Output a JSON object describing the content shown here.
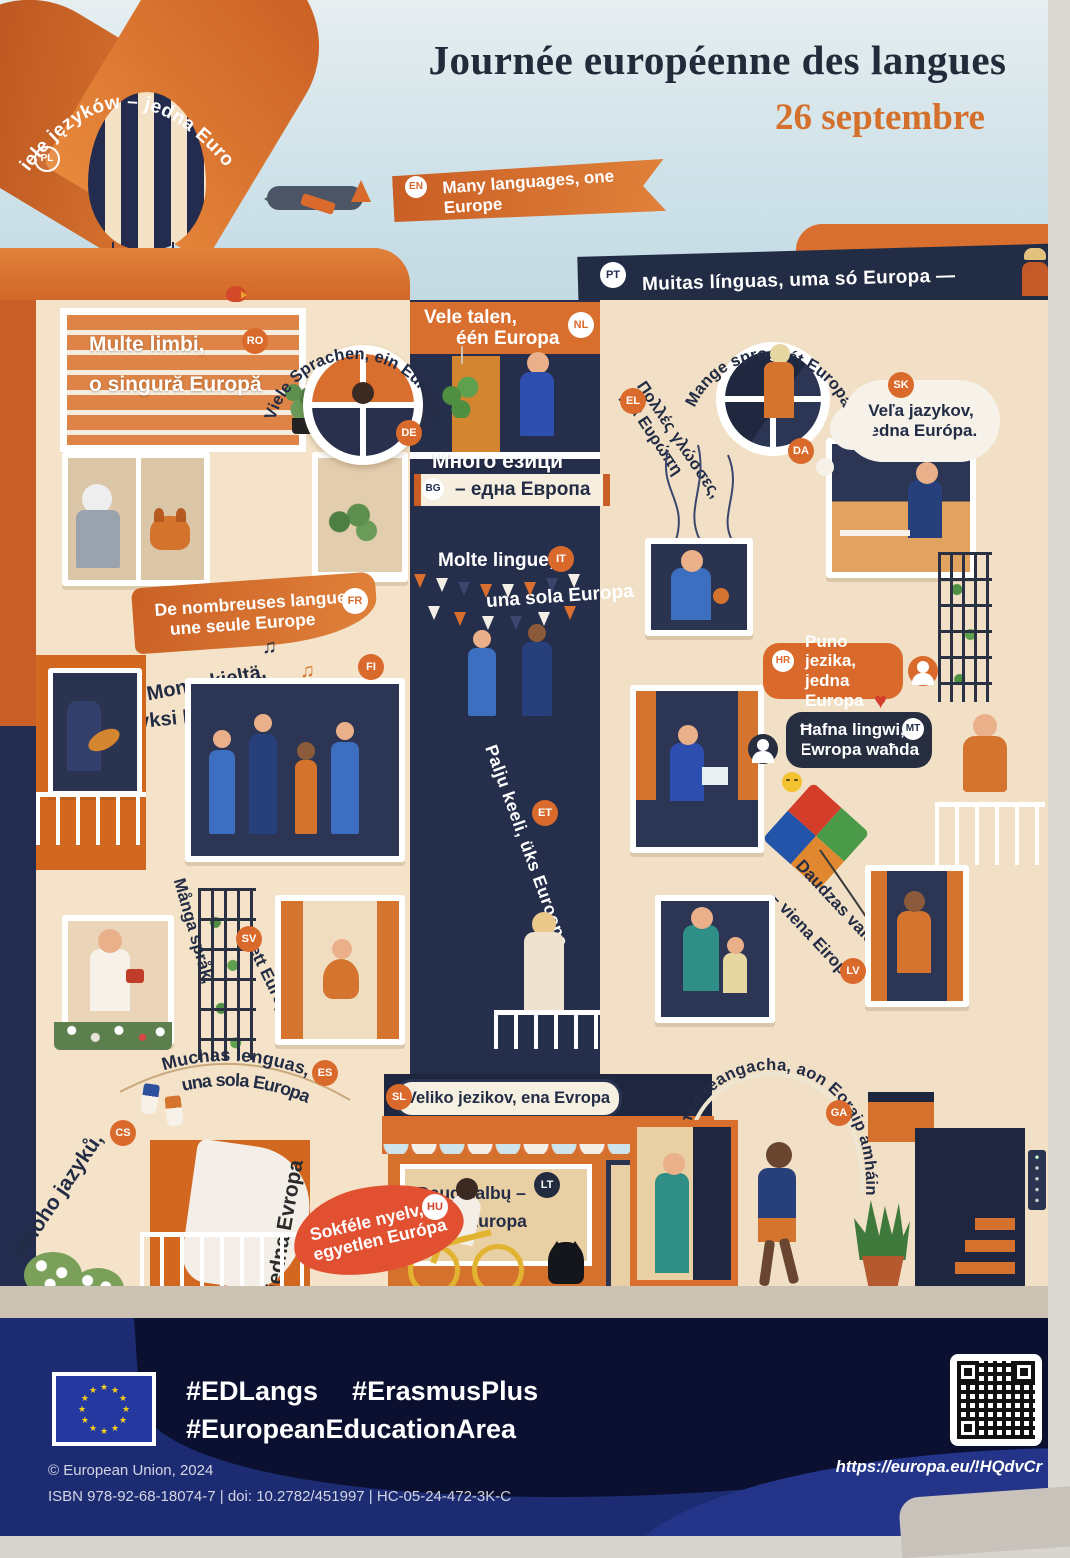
{
  "header": {
    "title": "Journée européenne des langues",
    "date": "26 septembre"
  },
  "languages": {
    "pl": {
      "code": "PL",
      "text": "Wiele języków – jedna Europa"
    },
    "en": {
      "code": "EN",
      "text": "Many languages, one Europe"
    },
    "pt": {
      "code": "PT",
      "text": "Muitas línguas, uma só Europa —"
    },
    "ro": {
      "code": "RO",
      "l1": "Multe limbi,",
      "l2": "o singură Europă"
    },
    "de": {
      "code": "DE",
      "text": "Viele Sprachen, ein Europa,"
    },
    "nl": {
      "code": "NL",
      "l1": "Vele talen,",
      "l2": "één Europa"
    },
    "bg": {
      "code": "BG",
      "l1": "Много езици",
      "l2": "– една Европа"
    },
    "el": {
      "code": "EL",
      "l1": "Πολλές γλώσσες,",
      "l2": "μία Ευρώπη"
    },
    "da": {
      "code": "DA",
      "text": "Mange sprog, ét Europa"
    },
    "sk": {
      "code": "SK",
      "l1": "Veľa jazykov,",
      "l2": "jedna Európa."
    },
    "it": {
      "code": "IT",
      "l1": "Molte lingue,",
      "l2": "una sola Europa"
    },
    "fr": {
      "code": "FR",
      "l1": "De nombreuses langues",
      "l2": "une seule Europe"
    },
    "fi": {
      "code": "FI",
      "l1": "Monta kieltä,",
      "l2": "yksi Eurooppa"
    },
    "hr": {
      "code": "HR",
      "l1": "Puno jezika,",
      "l2": "jedna Europa"
    },
    "mt": {
      "code": "MT",
      "l1": "Ħafna lingwi,",
      "l2": "Ewropa waħda"
    },
    "et": {
      "code": "ET",
      "text": "Palju keeli, üks Euroopa"
    },
    "sv": {
      "code": "SV",
      "l1": "Många språk,",
      "l2": "ett Europa"
    },
    "lv": {
      "code": "LV",
      "l1": "Daudzas valodas",
      "l2": "– viena Eiropa"
    },
    "es": {
      "code": "ES",
      "l1": "Muchas lenguas,",
      "l2": "una sola Europa"
    },
    "sl": {
      "code": "SL",
      "text": "Veliko jezikov, ena Evropa"
    },
    "lt": {
      "code": "LT",
      "l1": "Daug kalbų –",
      "l2": "viena Europa"
    },
    "cs": {
      "code": "CS",
      "l1": "Mnoho jazyků,",
      "l2": "jedna Evropa"
    },
    "hu": {
      "code": "HU",
      "l1": "Sokféle nyelv,",
      "l2": "egyetlen Európa"
    },
    "ga": {
      "code": "GA",
      "text": "An iliomad teangacha, aon Eoraip amháin"
    }
  },
  "icons": {
    "heart": "♥",
    "star": "★",
    "note_single": "♪",
    "note_double": "♫"
  },
  "footer": {
    "hashtags": [
      "#EDLangs",
      "#ErasmusPlus",
      "#EuropeanEducationArea"
    ],
    "copyright": "© European Union, 2024",
    "publication": "ISBN 978-92-68-18074-7 | doi: 10.2782/451997 | HC-05-24-472-3K-C",
    "url": "https://europa.eu/!HQdvCr"
  },
  "colors": {
    "accent_orange": "#d96a2b",
    "navy": "#232c45",
    "footer_blue": "#1c2b72",
    "sky": "#cfe2e9",
    "cream": "#f4e3c8"
  }
}
